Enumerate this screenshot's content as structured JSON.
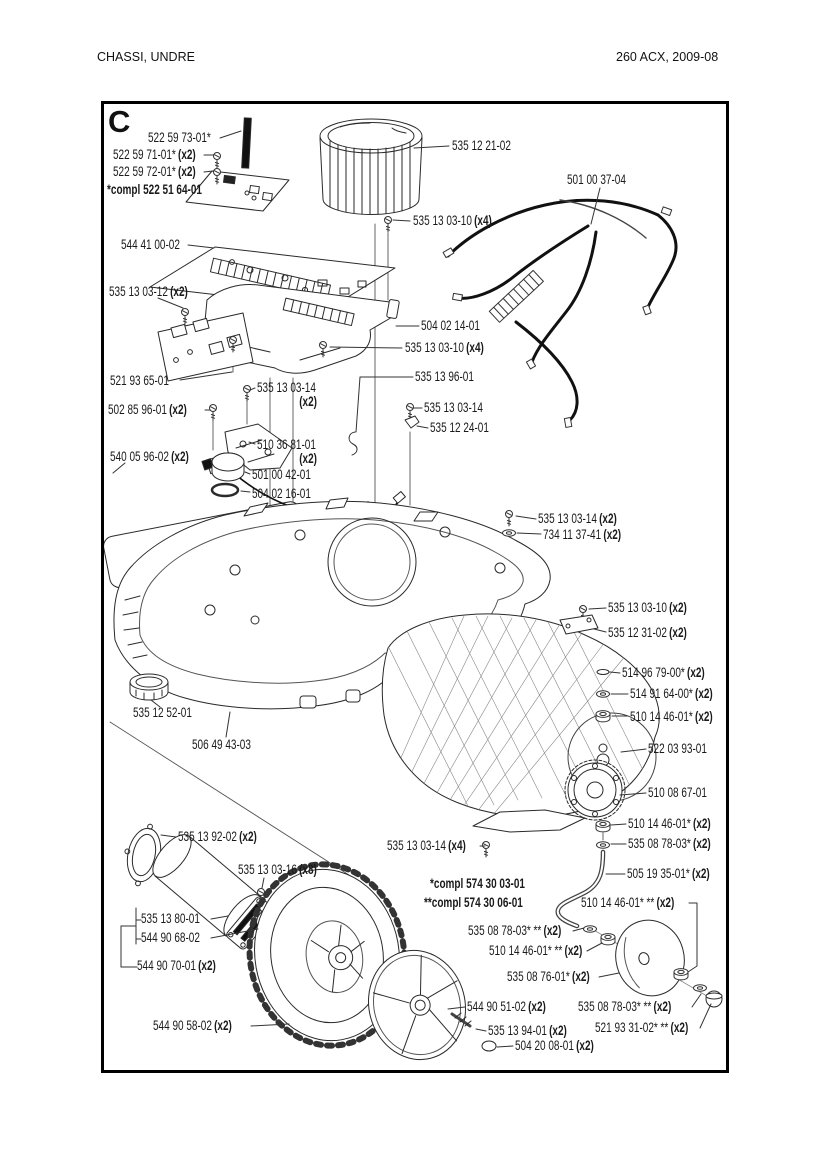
{
  "colors": {
    "ink": "#1a1a1a",
    "background": "#ffffff"
  },
  "page": {
    "title_left": "CHASSI, UNDRE",
    "title_right": "260 ACX, 2009-08"
  },
  "diagram": {
    "section": "C",
    "notes": [
      {
        "text": "*compl 522 51 64-01"
      },
      {
        "text": "*compl 574 30 03-01"
      },
      {
        "text": "**compl 574 30 06-01"
      }
    ],
    "callouts": [
      {
        "text": "522 59 73-01*",
        "qty": ""
      },
      {
        "text": "522 59 71-01*",
        "qty": "(x2)"
      },
      {
        "text": "522 59 72-01*",
        "qty": "(x2)"
      },
      {
        "text": "544 41 00-02",
        "qty": ""
      },
      {
        "text": "535 12 21-02",
        "qty": ""
      },
      {
        "text": "501 00 37-04",
        "qty": ""
      },
      {
        "text": "535 13 03-10",
        "qty": "(x4)"
      },
      {
        "text": "535 13 03-12",
        "qty": "(x2)"
      },
      {
        "text": "504 02 14-01",
        "qty": ""
      },
      {
        "text": "535 13 03-10",
        "qty": "(x4)"
      },
      {
        "text": "521 93 65-01",
        "qty": ""
      },
      {
        "text": "535 13 96-01",
        "qty": ""
      },
      {
        "text": "535 13 03-14",
        "qty": ""
      },
      {
        "text": "",
        "qty": "(x2)"
      },
      {
        "text": "502 85 96-01",
        "qty": "(x2)"
      },
      {
        "text": "535 13 03-14",
        "qty": ""
      },
      {
        "text": "535 12 24-01",
        "qty": ""
      },
      {
        "text": "540 05 96-02",
        "qty": "(x2)"
      },
      {
        "text": "510 36 81-01",
        "qty": ""
      },
      {
        "text": "",
        "qty": "(x2)"
      },
      {
        "text": "501 00 42-01",
        "qty": ""
      },
      {
        "text": "504 02 16-01",
        "qty": ""
      },
      {
        "text": "535 13 03-14",
        "qty": "(x2)"
      },
      {
        "text": "734 11 37-41",
        "qty": "(x2)"
      },
      {
        "text": "535 13 03-10",
        "qty": "(x2)"
      },
      {
        "text": "535 12 31-02",
        "qty": "(x2)"
      },
      {
        "text": "514 96 79-00*",
        "qty": "(x2)"
      },
      {
        "text": "514 91 64-00*",
        "qty": "(x2)"
      },
      {
        "text": "510 14 46-01*",
        "qty": "(x2)"
      },
      {
        "text": "522 03 93-01",
        "qty": ""
      },
      {
        "text": "510 08 67-01",
        "qty": ""
      },
      {
        "text": "535 12 52-01",
        "qty": ""
      },
      {
        "text": "506 49 43-03",
        "qty": ""
      },
      {
        "text": "510 14 46-01*",
        "qty": "(x2)"
      },
      {
        "text": "535 08 78-03*",
        "qty": "(x2)"
      },
      {
        "text": "535 13 03-14",
        "qty": "(x4)"
      },
      {
        "text": "505 19 35-01*",
        "qty": "(x2)"
      },
      {
        "text": "510 14 46-01* **",
        "qty": "(x2)"
      },
      {
        "text": "535 13 92-02",
        "qty": "(x2)"
      },
      {
        "text": "535 13 03-16",
        "qty": "(x8)"
      },
      {
        "text": "535 13 80-01",
        "qty": ""
      },
      {
        "text": "544 90 68-02",
        "qty": ""
      },
      {
        "text": "544 90 70-01",
        "qty": "(x2)"
      },
      {
        "text": "535 08 78-03* **",
        "qty": "(x2)"
      },
      {
        "text": "510 14 46-01* **",
        "qty": "(x2)"
      },
      {
        "text": "535 08 76-01*",
        "qty": "(x2)"
      },
      {
        "text": "544 90 58-02",
        "qty": "(x2)"
      },
      {
        "text": "544 90 51-02",
        "qty": "(x2)"
      },
      {
        "text": "535 13 94-01",
        "qty": "(x2)"
      },
      {
        "text": "504 20 08-01",
        "qty": "(x2)"
      },
      {
        "text": "535 08 78-03* **",
        "qty": "(x2)"
      },
      {
        "text": "521 93 31-02* **",
        "qty": "(x2)"
      }
    ]
  }
}
